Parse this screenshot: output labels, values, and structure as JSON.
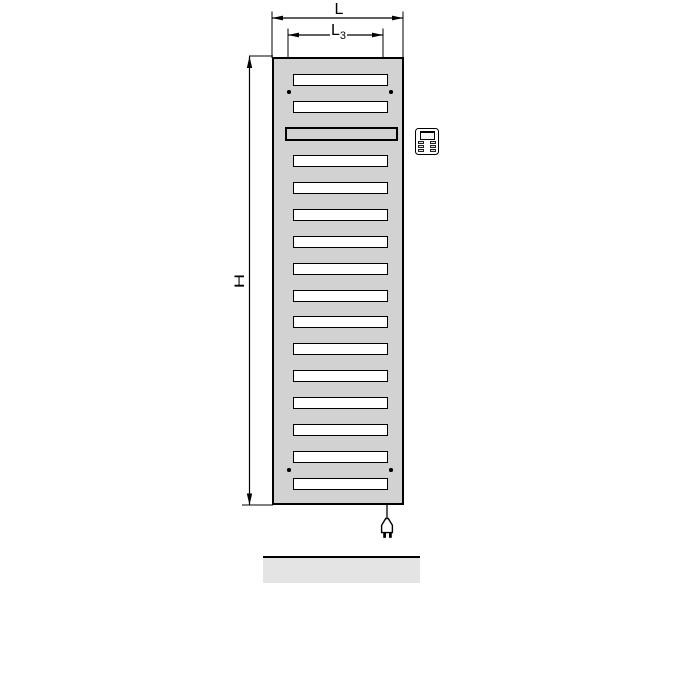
{
  "title": "Electric radiator dimension drawing",
  "labels": {
    "width": "L",
    "inner_width_base": "L",
    "inner_width_sub": "3",
    "height": "H"
  },
  "colors": {
    "radiator_fill": "#d2d2d2",
    "slot_fill": "#ffffff",
    "cover_slot_fill": "#d2d2d2",
    "floor_fill": "#e4e4e4",
    "outline": "#000000"
  },
  "radiator": {
    "rows": [
      {
        "type": "slot",
        "y": 80
      },
      {
        "type": "slot",
        "y": 107
      },
      {
        "type": "cover",
        "y": 134
      },
      {
        "type": "slot",
        "y": 161
      },
      {
        "type": "slot",
        "y": 188
      },
      {
        "type": "slot",
        "y": 215
      },
      {
        "type": "slot",
        "y": 242
      },
      {
        "type": "slot",
        "y": 269
      },
      {
        "type": "slot",
        "y": 296
      },
      {
        "type": "slot",
        "y": 322
      },
      {
        "type": "slot",
        "y": 349
      },
      {
        "type": "slot",
        "y": 376
      },
      {
        "type": "slot",
        "y": 403
      },
      {
        "type": "slot",
        "y": 430
      },
      {
        "type": "slot",
        "y": 457
      },
      {
        "type": "slot",
        "y": 484
      }
    ],
    "mount_dots": [
      {
        "x": 289,
        "y": 92
      },
      {
        "x": 391,
        "y": 92
      },
      {
        "x": 289,
        "y": 470
      },
      {
        "x": 391,
        "y": 470
      }
    ]
  },
  "icons": {
    "controller": "thermostat-controller-icon",
    "plug": "power-plug-icon"
  }
}
